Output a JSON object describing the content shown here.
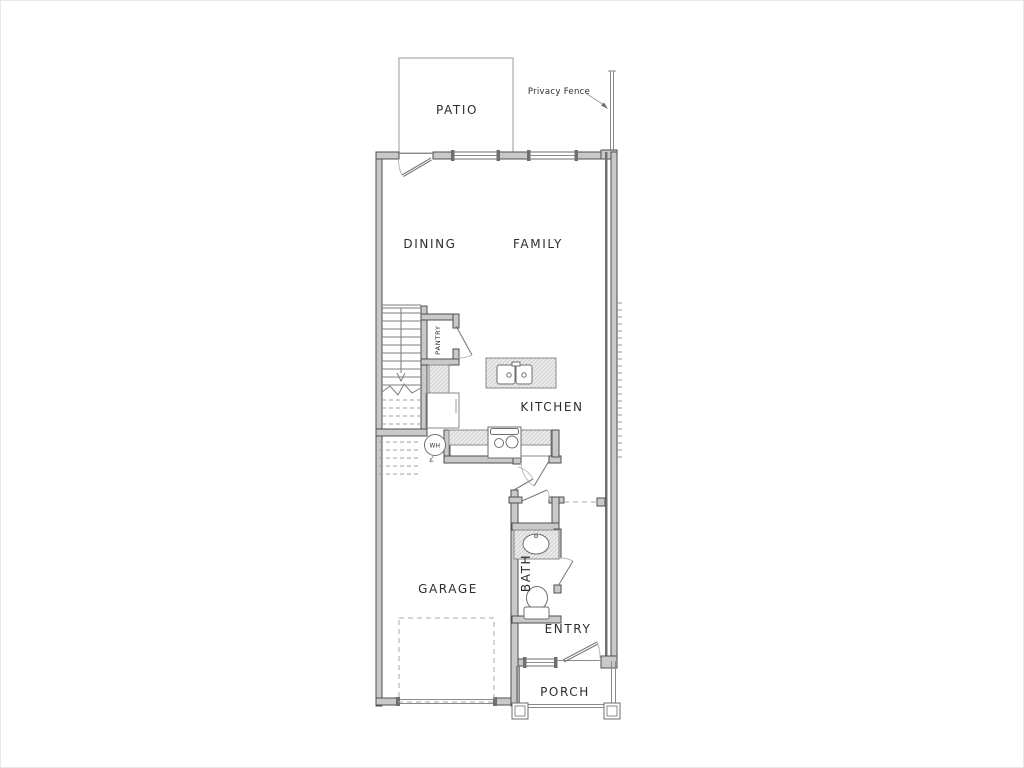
{
  "drawing": {
    "type": "residential-floor-plan",
    "labels": {
      "patio": "PATIO",
      "privacy_fence": "Privacy Fence",
      "dining": "DINING",
      "family": "FAMILY",
      "kitchen": "KITCHEN",
      "pantry": "PANTRY",
      "water_heater": "WH",
      "garage": "GARAGE",
      "bath": "BATH",
      "entry": "ENTRY",
      "porch": "PORCH"
    },
    "colors": {
      "background": "#ffffff",
      "wall_fill": "#c9c9c9",
      "wall_stroke": "#4e4e4e",
      "line": "#8a8a8a",
      "hatch_bg": "#ebebeb",
      "hatch_line": "#c6c6c6",
      "text": "#2d2d2d"
    }
  }
}
